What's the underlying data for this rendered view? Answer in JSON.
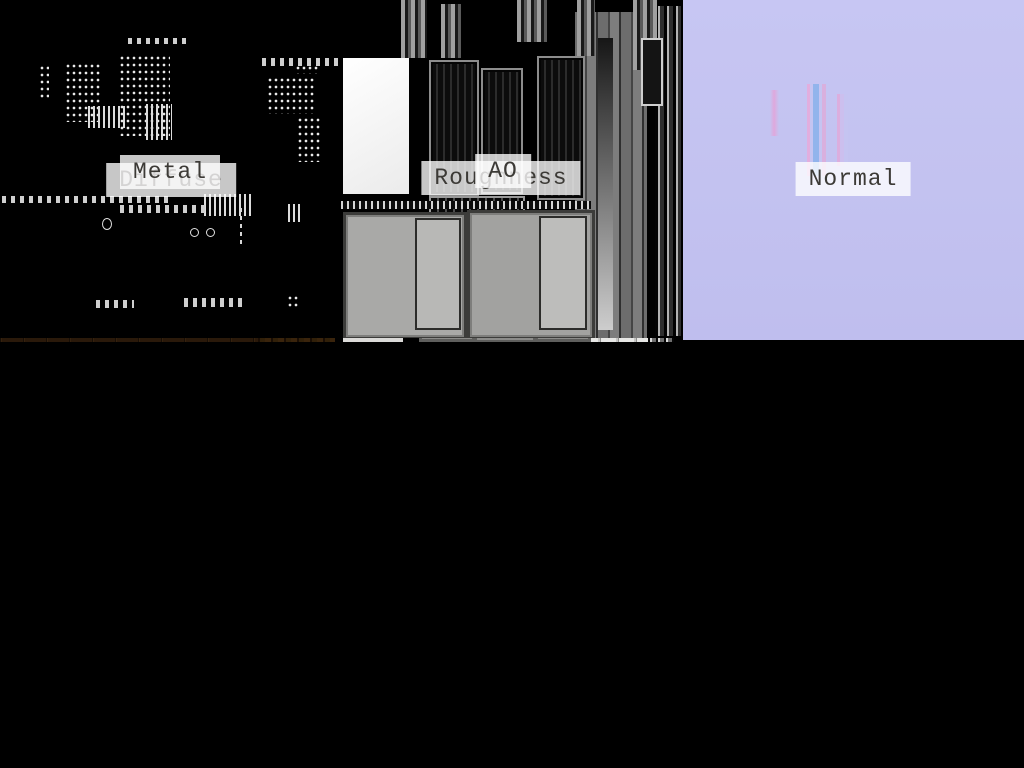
{
  "canvas": {
    "width": 1024,
    "height": 768,
    "background": "#000000"
  },
  "maps": [
    {
      "id": "diffuse",
      "label": "Diffuse",
      "dominant_color": "#3f2711"
    },
    {
      "id": "roughness",
      "label": "Roughness",
      "dominant_color": "#d9d9d7"
    },
    {
      "id": "normal",
      "label": "Normal",
      "dominant_color": "#c3c2f0"
    },
    {
      "id": "metal",
      "label": "Metal",
      "dominant_color": "#000000"
    },
    {
      "id": "ao",
      "label": "AO",
      "dominant_color": "#2e2e2e"
    }
  ],
  "label_style": {
    "background": "rgba(255,255,255,0.78)",
    "text_color": "#3c3a36"
  }
}
